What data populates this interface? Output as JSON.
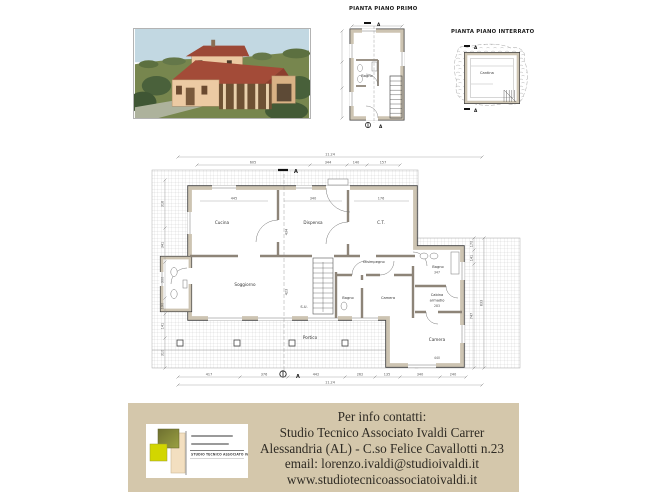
{
  "colors": {
    "contact_box": "#d4c7ab",
    "wall_fill": "#cdc4b2",
    "sky": "#c2d8e2",
    "grass": "#77864e",
    "roof": "#a14a38"
  },
  "plan_first": {
    "title": "PIANTA PIANO PRIMO",
    "bagno": "Bagno",
    "marker": "A"
  },
  "plan_basement": {
    "title": "PIANTA PIANO INTERRATO",
    "cantina": "Cantina",
    "marker": "A"
  },
  "plan_ground": {
    "marker": "A",
    "rooms": {
      "cucina": "Cucina",
      "dispensa": "Dispensa",
      "ct": "C.T.",
      "soggiorno": "Soggiorno",
      "disimpegno": "Disimpegno",
      "bagno_center": "Bagno",
      "camera_center": "Camera",
      "bagno_right": "Bagno",
      "cabina_line1": "Cabina",
      "cabina_line2": "armadio",
      "camera_bottom": "Camera",
      "portico": "Portico",
      "stairs": "S.U."
    },
    "dims": {
      "total": "11.24",
      "top": [
        "605",
        "344",
        "140",
        "157"
      ],
      "inner_top": [
        "445",
        "340",
        "176"
      ],
      "inner_vertical": [
        "434",
        "423"
      ],
      "bottom": [
        "417",
        "376",
        "442",
        "262",
        "135",
        "340",
        "240"
      ],
      "left": [
        "318",
        "341",
        "300",
        "190",
        "141",
        "310"
      ],
      "right": [
        "170",
        "141",
        "747",
        "833"
      ],
      "room": [
        "347",
        "283",
        "440"
      ]
    }
  },
  "contact": {
    "heading": "Per info contatti:",
    "studio": "Studio Tecnico Associato Ivaldi Carrer",
    "address": "Alessandria (AL) - C.so Felice Cavallotti n.23",
    "email": "email: lorenzo.ivaldi@studioivaldi.it",
    "website": "www.studiotecnicoassociatoivaldi.it"
  },
  "logo": {
    "studio_name": "STUDIO TECNICO ASSOCIATO IVALDI"
  }
}
